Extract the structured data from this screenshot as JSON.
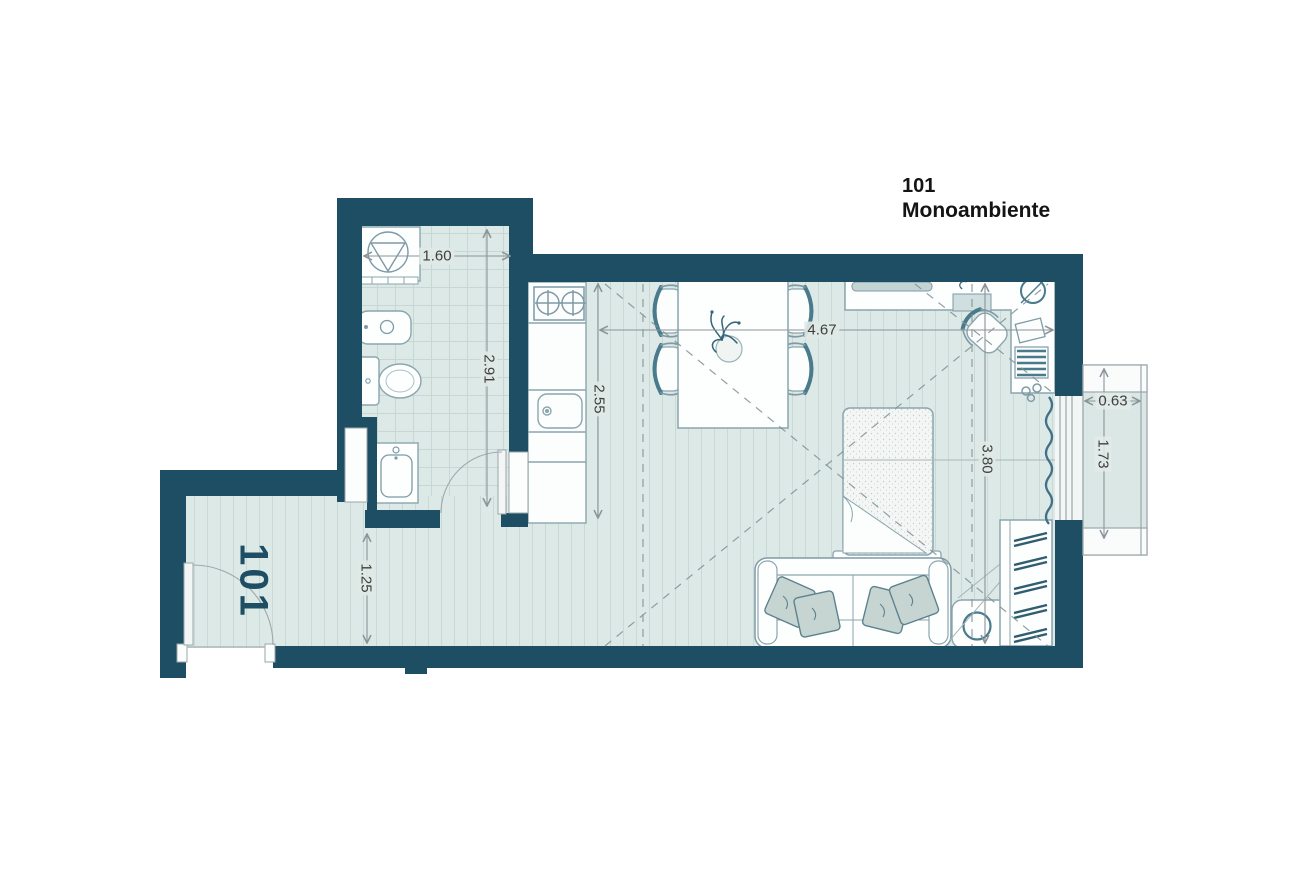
{
  "title": {
    "unit_number": "101",
    "unit_name": "Monoambiente"
  },
  "hall_label": "101",
  "dimensions": {
    "bathroom_width": "1.60",
    "bathroom_depth": "2.91",
    "kitchen_depth": "2.55",
    "living_width": "4.67",
    "living_depth": "3.80",
    "hall_width": "1.25",
    "balcony_width": "0.63",
    "balcony_depth": "1.73"
  },
  "colors": {
    "wall": "#1d4e63",
    "floor": "#dde9e6",
    "fixture_stroke": "#8aa5ae",
    "accent": "#35657a",
    "dim_line": "#8b9499",
    "dim_text": "#3f3f3f",
    "pillow": "#c6d5d2",
    "balcony_glass": "#dbe7e4",
    "title_text": "#141414"
  },
  "furniture": [
    "shower",
    "bidet",
    "toilet",
    "sink-vanity",
    "kitchen-counter",
    "stove",
    "kitchen-sink",
    "dining-table",
    "dining-chairs",
    "plant",
    "desk",
    "desk-chair",
    "bed",
    "sofa",
    "pillows",
    "side-table",
    "wardrobe",
    "curtain",
    "balcony",
    "entry-door",
    "bathroom-door"
  ]
}
